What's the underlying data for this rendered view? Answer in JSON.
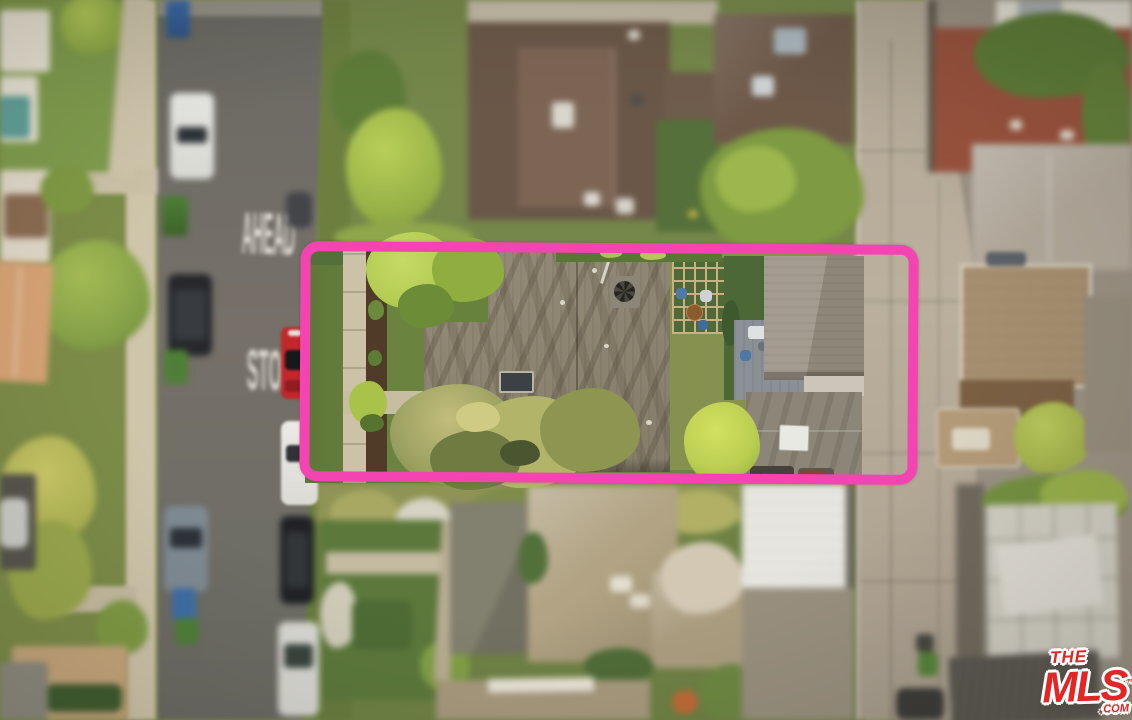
{
  "road_markings": {
    "ahead": "AHEAD",
    "stop": "STOP"
  },
  "watermark": {
    "line1": "THE",
    "line2": "MLS",
    "suffix": ".COM",
    "trademark": "™",
    "brand_color": "#e32526",
    "outline_color": "#ffffff"
  },
  "highlight_box": {
    "color": "#f444b1"
  }
}
